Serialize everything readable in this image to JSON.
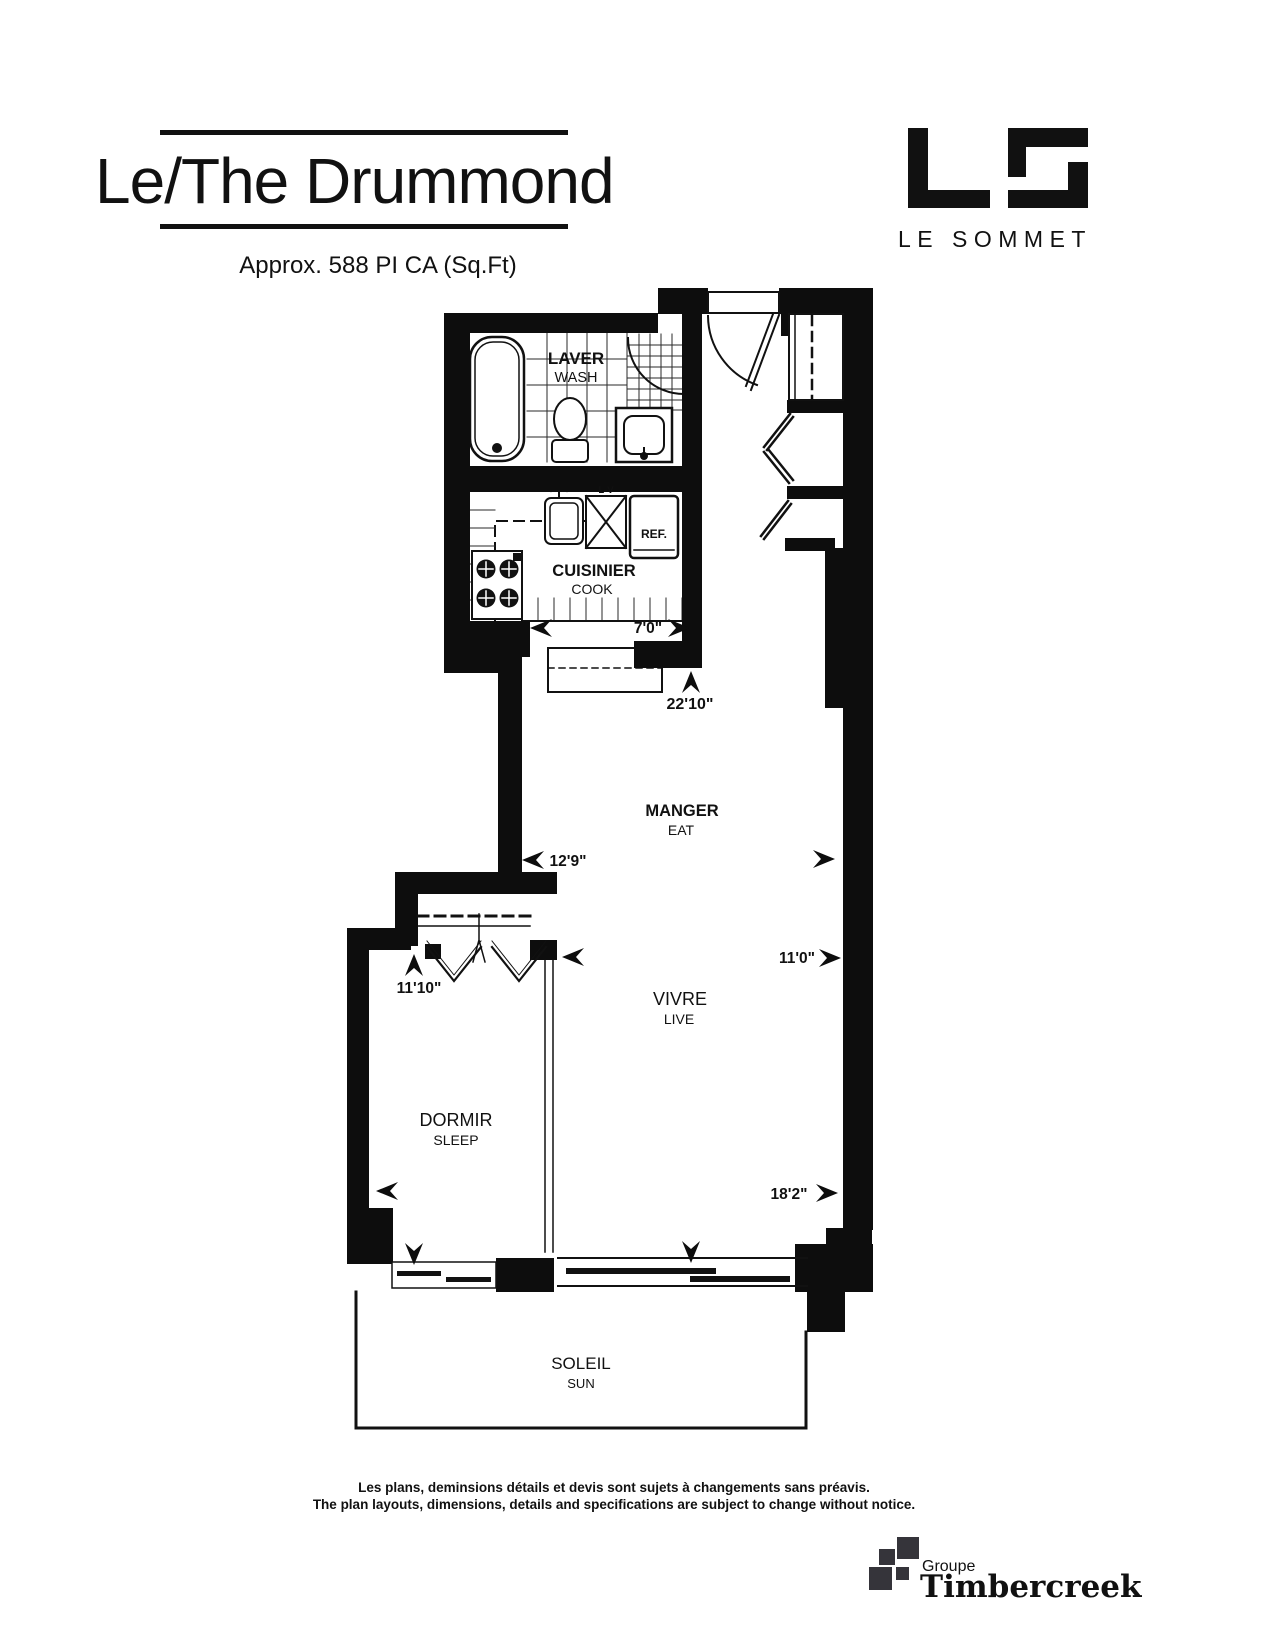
{
  "header": {
    "title": "Le/The Drummond",
    "subtitle": "Approx. 588 PI CA (Sq.Ft)"
  },
  "brand": {
    "wordmark": "LE SOMMET"
  },
  "plan": {
    "rooms": {
      "wash": {
        "fr": "LAVER",
        "en": "WASH"
      },
      "cook": {
        "fr": "CUISINIER",
        "en": "COOK"
      },
      "eat": {
        "fr": "MANGER",
        "en": "EAT"
      },
      "live": {
        "fr": "VIVRE",
        "en": "LIVE"
      },
      "sleep": {
        "fr": "DORMIR",
        "en": "SLEEP"
      },
      "sun": {
        "fr": "SOLEIL",
        "en": "SUN"
      }
    },
    "appliances": {
      "fridge": "REF.",
      "dishwasher": "L-V"
    },
    "dimensions": {
      "kitchen_width": "7'0\"",
      "unit_depth": "22'10\"",
      "eat_width": "12'9\"",
      "sleep_width": "11'10\"",
      "live_width": "11'0\"",
      "unit_width": "18'2\""
    }
  },
  "footer": {
    "disclaimer_fr": "Les plans, deminsions détails et devis sont sujets à changements sans préavis.",
    "disclaimer_en": "The plan layouts, dimensions, details and specifications are subject to change without notice.",
    "groupe_label": "Groupe",
    "groupe_brand": "Timbercreek"
  },
  "colors": {
    "ink": "#111111",
    "logo_gray": "#35343a"
  }
}
